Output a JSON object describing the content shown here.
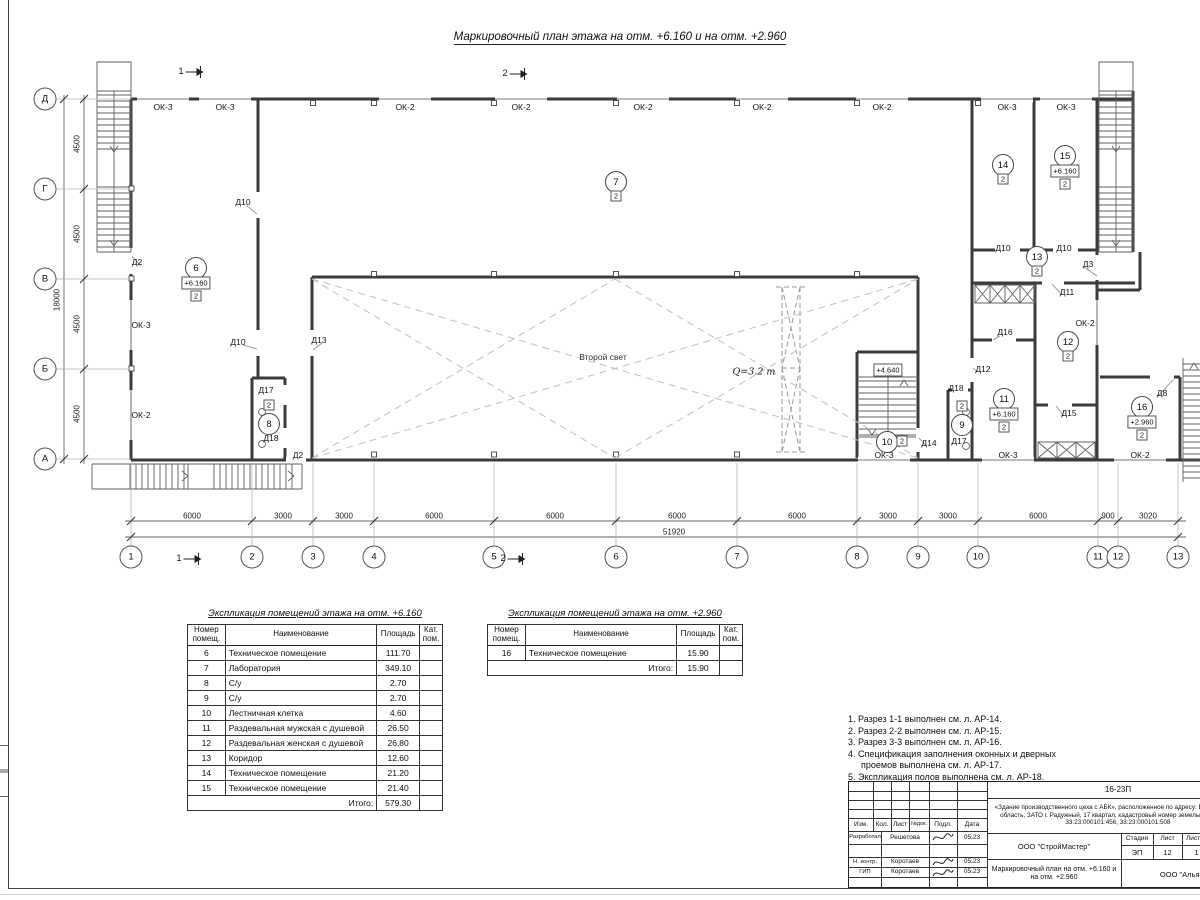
{
  "title": "Маркировочный план этажа на отм. +6.160 и на отм. +2.960",
  "plan": {
    "axes_h": [
      {
        "n": "1",
        "x": 131
      },
      {
        "n": "2",
        "x": 252
      },
      {
        "n": "3",
        "x": 313
      },
      {
        "n": "4",
        "x": 374
      },
      {
        "n": "5",
        "x": 494
      },
      {
        "n": "6",
        "x": 616
      },
      {
        "n": "7",
        "x": 737
      },
      {
        "n": "8",
        "x": 857
      },
      {
        "n": "9",
        "x": 918
      },
      {
        "n": "10",
        "x": 978
      },
      {
        "n": "11",
        "x": 1098
      },
      {
        "n": "12",
        "x": 1118
      },
      {
        "n": "13",
        "x": 1178
      }
    ],
    "axes_v": [
      {
        "n": "Д",
        "y": 99
      },
      {
        "n": "Г",
        "y": 189
      },
      {
        "n": "В",
        "y": 279
      },
      {
        "n": "Б",
        "y": 369
      },
      {
        "n": "А",
        "y": 459
      }
    ],
    "dims_bottom": [
      {
        "t": "6000",
        "x": 192
      },
      {
        "t": "3000",
        "x": 283
      },
      {
        "t": "3000",
        "x": 344
      },
      {
        "t": "6000",
        "x": 434
      },
      {
        "t": "6000",
        "x": 555
      },
      {
        "t": "6000",
        "x": 677
      },
      {
        "t": "6000",
        "x": 797
      },
      {
        "t": "3000",
        "x": 888
      },
      {
        "t": "3000",
        "x": 948
      },
      {
        "t": "6000",
        "x": 1038
      },
      {
        "t": "900",
        "x": 1108
      },
      {
        "t": "3020",
        "x": 1148
      }
    ],
    "dim_total_bottom": {
      "t": "51920",
      "x": 674,
      "y": 532
    },
    "dims_left": [
      {
        "t": "4500",
        "y": 144
      },
      {
        "t": "4500",
        "y": 234
      },
      {
        "t": "4500",
        "y": 324
      },
      {
        "t": "4500",
        "y": 414
      }
    ],
    "dim_total_left": {
      "t": "18000",
      "x": 57,
      "y": 300
    },
    "labels": [
      {
        "t": "ОК-3",
        "x": 163,
        "y": 107,
        "k": "win"
      },
      {
        "t": "ОК-3",
        "x": 225,
        "y": 107,
        "k": "win"
      },
      {
        "t": "ОК-2",
        "x": 405,
        "y": 107,
        "k": "win"
      },
      {
        "t": "ОК-2",
        "x": 521,
        "y": 107,
        "k": "win"
      },
      {
        "t": "ОК-2",
        "x": 643,
        "y": 107,
        "k": "win"
      },
      {
        "t": "ОК-2",
        "x": 762,
        "y": 107,
        "k": "win"
      },
      {
        "t": "ОК-2",
        "x": 882,
        "y": 107,
        "k": "win"
      },
      {
        "t": "ОК-3",
        "x": 1007,
        "y": 107,
        "k": "win"
      },
      {
        "t": "ОК-3",
        "x": 1066,
        "y": 107,
        "k": "win"
      },
      {
        "t": "ОК-3",
        "x": 141,
        "y": 325,
        "k": "win"
      },
      {
        "t": "ОК-2",
        "x": 141,
        "y": 415,
        "k": "win"
      },
      {
        "t": "ОК-3",
        "x": 884,
        "y": 455,
        "k": "win"
      },
      {
        "t": "ОК-3",
        "x": 1008,
        "y": 455,
        "k": "win"
      },
      {
        "t": "ОК-2",
        "x": 1140,
        "y": 455,
        "k": "win"
      },
      {
        "t": "ОК-2",
        "x": 1085,
        "y": 323,
        "k": "win"
      },
      {
        "t": "Д2",
        "x": 137,
        "y": 262,
        "k": "door"
      },
      {
        "t": "Д10",
        "x": 243,
        "y": 202,
        "k": "door"
      },
      {
        "t": "Д10",
        "x": 238,
        "y": 342,
        "k": "door"
      },
      {
        "t": "Д13",
        "x": 319,
        "y": 340,
        "k": "door"
      },
      {
        "t": "Д17",
        "x": 266,
        "y": 390,
        "k": "door"
      },
      {
        "t": "Д18",
        "x": 271,
        "y": 438,
        "k": "door"
      },
      {
        "t": "Д2",
        "x": 298,
        "y": 455,
        "k": "door"
      },
      {
        "t": "Д14",
        "x": 929,
        "y": 443,
        "k": "door"
      },
      {
        "t": "Д16",
        "x": 1005,
        "y": 332,
        "k": "door"
      },
      {
        "t": "Д12",
        "x": 983,
        "y": 369,
        "k": "door"
      },
      {
        "t": "Д18",
        "x": 956,
        "y": 388,
        "k": "door"
      },
      {
        "t": "Д17",
        "x": 959,
        "y": 441,
        "k": "door"
      },
      {
        "t": "Д15",
        "x": 1069,
        "y": 413,
        "k": "door"
      },
      {
        "t": "Д11",
        "x": 1067,
        "y": 292,
        "k": "door"
      },
      {
        "t": "Д3",
        "x": 1088,
        "y": 264,
        "k": "door"
      },
      {
        "t": "Д8",
        "x": 1162,
        "y": 393,
        "k": "door"
      },
      {
        "t": "Д10",
        "x": 1003,
        "y": 248,
        "k": "door"
      },
      {
        "t": "Д10",
        "x": 1064,
        "y": 248,
        "k": "door"
      },
      {
        "t": "Второй свет",
        "x": 603,
        "y": 357,
        "k": "ann"
      },
      {
        "t": "Q=3.2 т",
        "x": 754,
        "y": 372,
        "k": "crane"
      }
    ],
    "elevations": [
      {
        "t": "+4.640",
        "x": 888,
        "y": 370
      }
    ],
    "rooms": [
      {
        "n": "6",
        "x": 196,
        "y": 268,
        "elev": "+6.160",
        "cat": "2"
      },
      {
        "n": "7",
        "x": 616,
        "y": 182,
        "cat": "2"
      },
      {
        "n": "8",
        "x": 269,
        "y": 424,
        "cat": "2",
        "catPos": "above"
      },
      {
        "n": "9",
        "x": 962,
        "y": 425,
        "cat": "2",
        "catPos": "above"
      },
      {
        "n": "10",
        "x": 887,
        "y": 442,
        "cat": "2",
        "catPos": "right"
      },
      {
        "n": "11",
        "x": 1004,
        "y": 399,
        "elev": "+6.160",
        "cat": "2"
      },
      {
        "n": "12",
        "x": 1068,
        "y": 342,
        "cat": "2"
      },
      {
        "n": "13",
        "x": 1037,
        "y": 257,
        "cat": "2"
      },
      {
        "n": "14",
        "x": 1003,
        "y": 165,
        "cat": "2"
      },
      {
        "n": "15",
        "x": 1065,
        "y": 156,
        "elev": "+6.160",
        "cat": "2"
      },
      {
        "n": "16",
        "x": 1142,
        "y": 407,
        "elev": "+2.960",
        "cat": "2"
      }
    ],
    "sections": [
      {
        "n": "1",
        "x": 192,
        "y": 71
      },
      {
        "n": "2",
        "x": 516,
        "y": 73
      },
      {
        "n": "1",
        "x": 190,
        "y": 558
      },
      {
        "n": "2",
        "x": 514,
        "y": 558
      }
    ]
  },
  "tables": [
    {
      "title": "Экспликация помещений этажа на отм. +6.160",
      "headers": [
        "Номер помещ.",
        "Наименование",
        "Площадь",
        "Кат. пом."
      ],
      "rows": [
        [
          "6",
          "Техническое помещение",
          "111.70"
        ],
        [
          "7",
          "Лаборатория",
          "349.10"
        ],
        [
          "8",
          "С/у",
          "2.70"
        ],
        [
          "9",
          "С/у",
          "2.70"
        ],
        [
          "10",
          "Лестничная клетка",
          "4.60"
        ],
        [
          "11",
          "Раздевальная мужская с душевой",
          "26.50"
        ],
        [
          "12",
          "Раздевальная женская с душевой",
          "26.80"
        ],
        [
          "13",
          "Коридор",
          "12.60"
        ],
        [
          "14",
          "Техническое помещение",
          "21.20"
        ],
        [
          "15",
          "Техническое помещение",
          "21.40"
        ]
      ],
      "total_label": "Итого:",
      "total": "579.30"
    },
    {
      "title": "Экспликация помещений этажа на отм. +2.960",
      "headers": [
        "Номер помещ.",
        "Наименование",
        "Площадь",
        "Кат. пом."
      ],
      "rows": [
        [
          "16",
          "Техническое помещение",
          "15.90"
        ]
      ],
      "total_label": "Итого:",
      "total": "15.90"
    }
  ],
  "notes": [
    "1. Разрез 1-1 выполнен см. л. АР-14.",
    "2. Разрез 2-2 выполнен см. л. АР-15.",
    "3. Разрез 3-3 выполнен см. л. АР-16.",
    "4. Спецификация заполнения оконных и дверных проемов выполнена см. л. АР-17.",
    "5. Экспликация полов выполнена см. л. АР-18."
  ],
  "titleblock": {
    "code": "16-23П",
    "description": "«Здание производственного цеха с АБК», расположенное по адресу: Владимирская область, ЗАТО г. Радужный, 17 квартал, кадастровый номер земельного участка 33:23:000101:456, 33:23:000101:508",
    "cols": [
      "Изм.",
      "Кол.",
      "Лист",
      "№док.",
      "Подл.",
      "Дата"
    ],
    "sig_rows": [
      {
        "role": "Разработал",
        "name": "Решетова",
        "date": "05.23"
      },
      {
        "role": "Н. контр.",
        "name": "Коротаев",
        "date": "05.23"
      },
      {
        "role": "ГИП",
        "name": "Коротаев",
        "date": "05.23"
      }
    ],
    "org": "ООО \"СтройМастер\"",
    "stage_label": "Стадия",
    "sheet_label": "Лист",
    "sheets_label": "Листов",
    "stage": "ЭП",
    "sheet": "12",
    "sheets": "1",
    "doc_title": "Маркировочный план на отм. +6.160 и на отм. +2.960",
    "org2": "ООО \"Альянс\""
  }
}
